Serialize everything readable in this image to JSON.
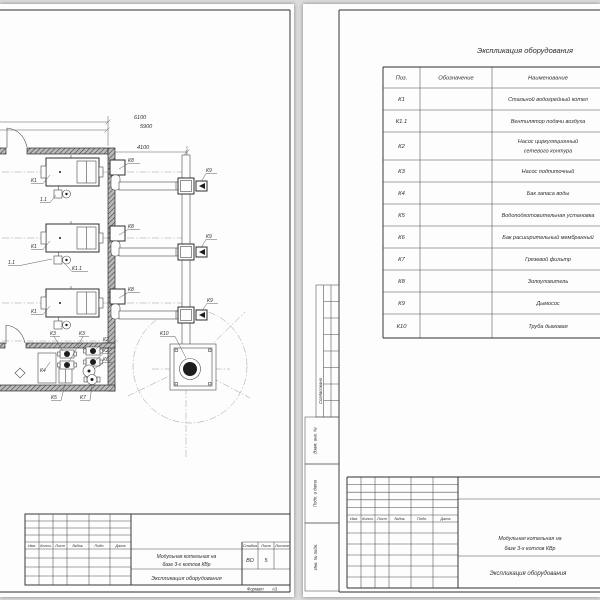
{
  "left_sheet": {
    "drawing": {
      "dim_labels": [
        "6100",
        "5900",
        "4100"
      ],
      "labels": {
        "k1_a": "К1",
        "k1_b": "К1",
        "k1_c": "К1",
        "fan_a": "1.1",
        "fan_b": "1.1",
        "fan_c": "К1.1",
        "k8_a": "К8",
        "k8_b": "К8",
        "k8_c": "К8",
        "k9_a": "К9",
        "k9_b": "К9",
        "k9_c": "К9",
        "k10": "К10",
        "k3_a": "К3",
        "k3_b": "К3",
        "k2_a": "К2",
        "k2_b": "К2",
        "k6": "К6",
        "k4": "К4",
        "k5": "К5",
        "k7": "К7"
      }
    },
    "title_block": {
      "rev_headers": [
        "Изм.",
        "Колич.",
        "Лист",
        "№док.",
        "Подп.",
        "Дата"
      ],
      "project_lines": [
        "Модульная котельная на",
        "базе 3-х котлов КВр"
      ],
      "document": "Экспликация оборудования",
      "stage_headers": [
        "Стадия",
        "Лист",
        "Листов"
      ],
      "stage": "ВО",
      "sheet_no": "5",
      "sheets_total": "",
      "format_label": "Формат",
      "format_value": "А3"
    }
  },
  "right_sheet": {
    "table": {
      "title": "Экспликация оборудования",
      "headers": [
        "Поз.",
        "Обозначение",
        "Наименование"
      ],
      "rows": [
        {
          "pos": "К1",
          "designation": "",
          "name_lines": [
            "Стальной водогрейный котел"
          ]
        },
        {
          "pos": "К1.1",
          "designation": "",
          "name_lines": [
            "Вентилятор подачи воздуха"
          ]
        },
        {
          "pos": "К2",
          "designation": "",
          "name_lines": [
            "Насос циркуляционный",
            "сетевого контура"
          ]
        },
        {
          "pos": "К3",
          "designation": "",
          "name_lines": [
            "Насос подпиточный"
          ]
        },
        {
          "pos": "К4",
          "designation": "",
          "name_lines": [
            "Бак запаса воды"
          ]
        },
        {
          "pos": "К5",
          "designation": "",
          "name_lines": [
            "Водоподготовительная установка"
          ]
        },
        {
          "pos": "К6",
          "designation": "",
          "name_lines": [
            "Бак расширительный мембранный"
          ]
        },
        {
          "pos": "К7",
          "designation": "",
          "name_lines": [
            "Грязевой фильтр"
          ]
        },
        {
          "pos": "К8",
          "designation": "",
          "name_lines": [
            "Золоуловитель"
          ]
        },
        {
          "pos": "К9",
          "designation": "",
          "name_lines": [
            "Дымосос"
          ]
        },
        {
          "pos": "К10",
          "designation": "",
          "name_lines": [
            "Труба дымовая"
          ]
        }
      ]
    },
    "margin_stamps": {
      "approved": "Согласовано",
      "vzam": "Взам. инв. №",
      "podp": "Подп. и дата",
      "inv": "Инв. № подл."
    },
    "title_block": {
      "rev_headers": [
        "Изм.",
        "Колич.",
        "Лист",
        "№док.",
        "Подп.",
        "Дата"
      ],
      "project_lines": [
        "Модульная котельная на",
        "базе 3-х котлов КВр"
      ],
      "document": "Экспликация оборудования"
    }
  }
}
